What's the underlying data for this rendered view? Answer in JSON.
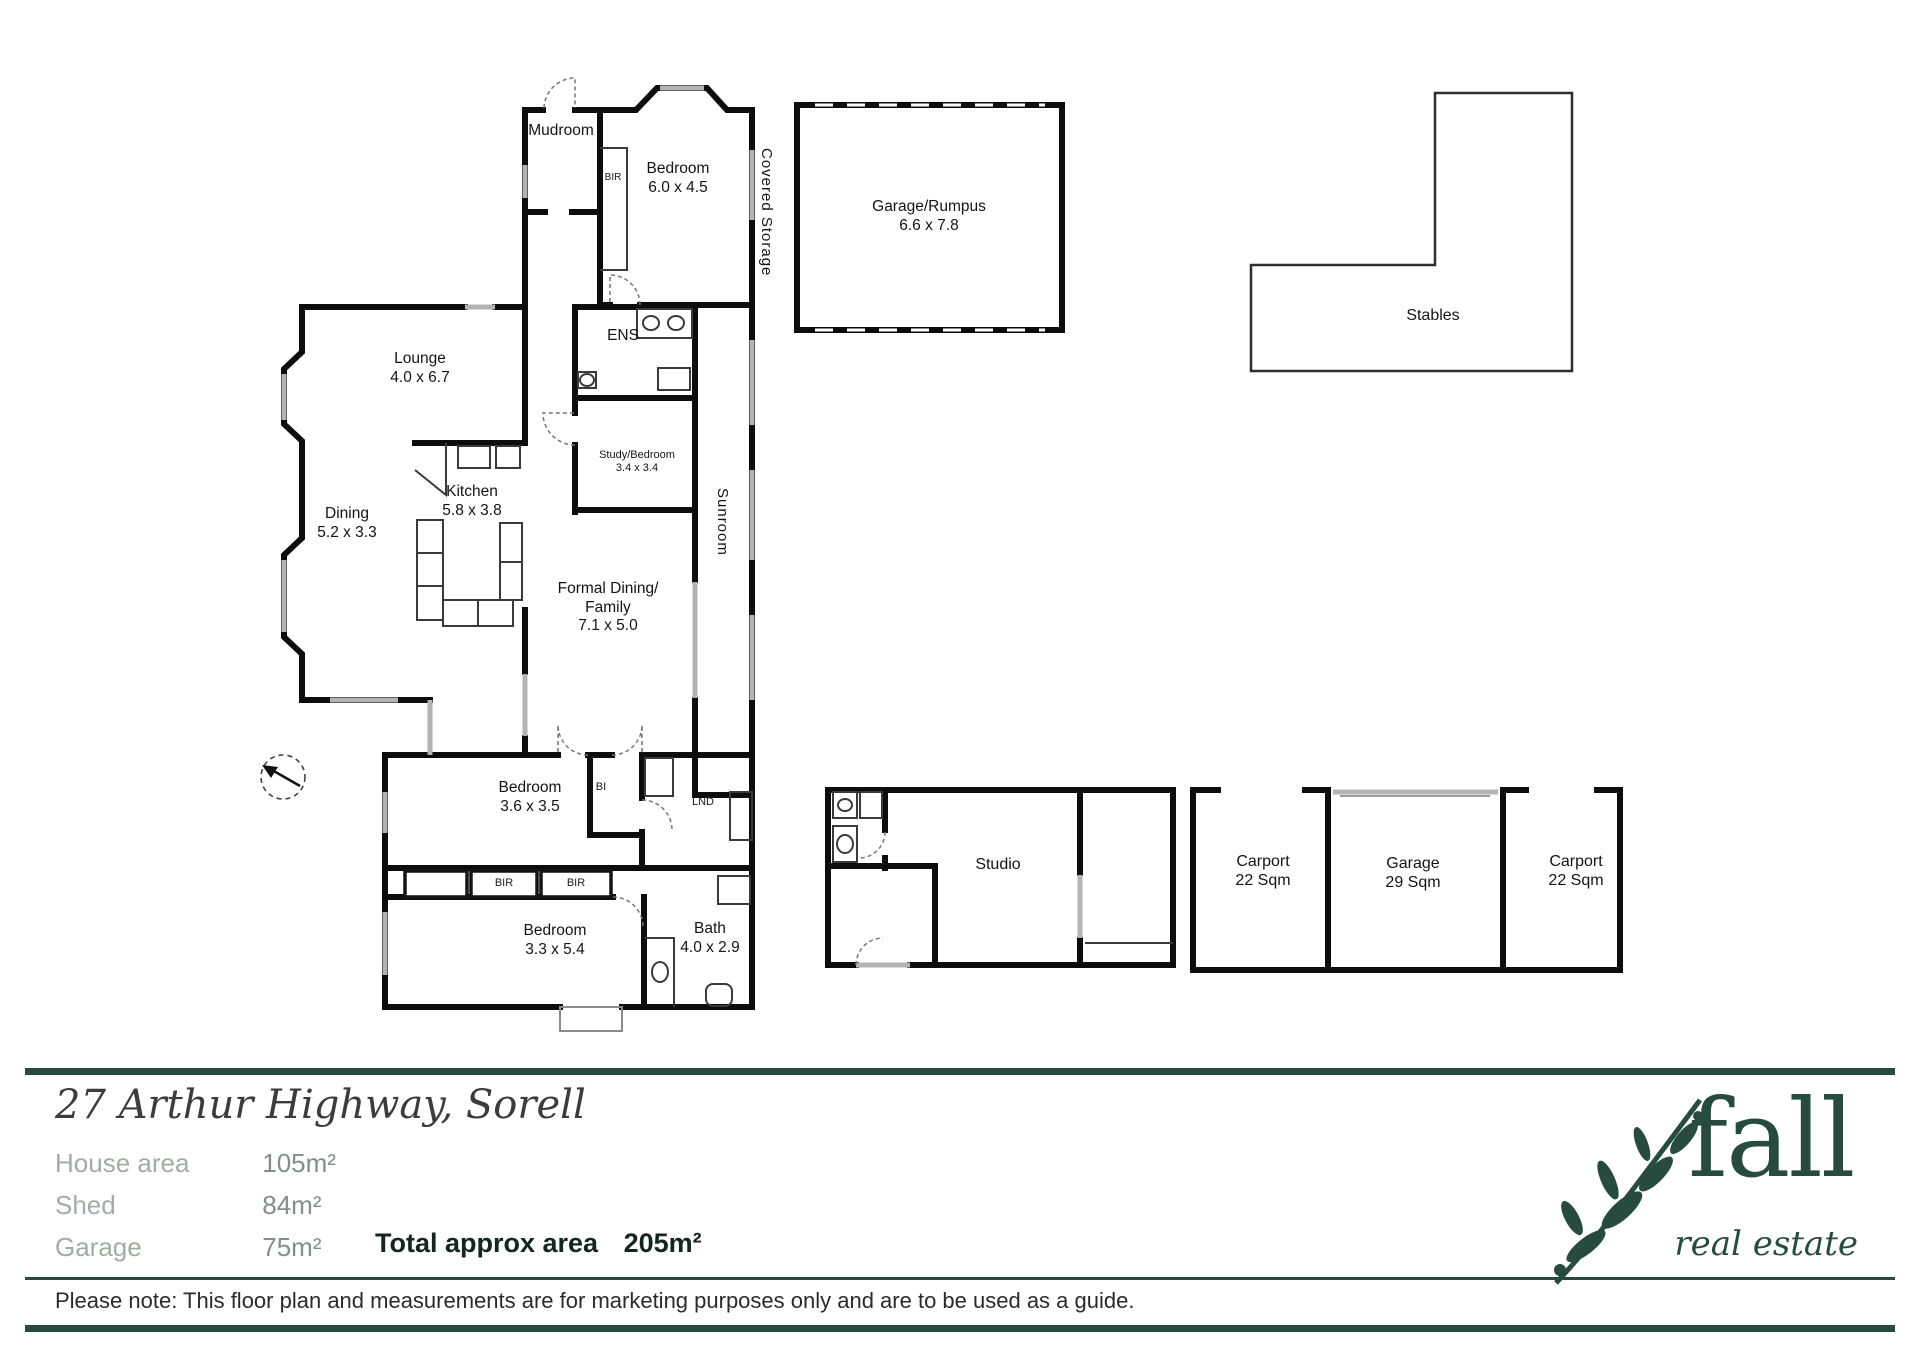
{
  "accent": "#274c3d",
  "rooms": {
    "mudroom": {
      "name": "Mudroom"
    },
    "bedroom_top": {
      "name": "Bedroom",
      "dims": "6.0 x 4.5"
    },
    "bir_top": "BIR",
    "covered_storage": "Covered Storage",
    "garage_rumpus": {
      "name": "Garage/Rumpus",
      "dims": "6.6 x 7.8"
    },
    "stables": "Stables",
    "lounge": {
      "name": "Lounge",
      "dims": "4.0 x 6.7"
    },
    "dining": {
      "name": "Dining",
      "dims": "5.2 x 3.3"
    },
    "kitchen": {
      "name": "Kitchen",
      "dims": "5.8 x 3.8"
    },
    "ens": "ENS",
    "study_bedroom": {
      "name": "Study/Bedroom",
      "dims": "3.4 x 3.4"
    },
    "sunroom": "Sunroom",
    "formal_dining": {
      "line1": "Formal Dining/",
      "line2": "Family",
      "dims": "7.1 x 5.0"
    },
    "bedroom_mid": {
      "name": "Bedroom",
      "dims": "3.6 x 3.5"
    },
    "bi": "BI",
    "lnd": "LND",
    "bir_a": "BIR",
    "bir_b": "BIR",
    "bedroom_bottom": {
      "name": "Bedroom",
      "dims": "3.3 x 5.4"
    },
    "bath": {
      "name": "Bath",
      "dims": "4.0 x 2.9"
    },
    "studio": "Studio",
    "carport_left": {
      "name": "Carport",
      "dims": "22 Sqm"
    },
    "garage_shed": {
      "name": "Garage",
      "dims": "29 Sqm"
    },
    "carport_right": {
      "name": "Carport",
      "dims": "22 Sqm"
    }
  },
  "footer": {
    "address": "27 Arthur Highway, Sorell",
    "area_rows": [
      {
        "label": "House area",
        "value": "105m²"
      },
      {
        "label": "Shed",
        "value": "84m²"
      },
      {
        "label": "Garage",
        "value": "75m²"
      }
    ],
    "total_label": "Total approx area",
    "total_value": "205m²",
    "disclaimer": "Please note: This floor plan and measurements are for marketing purposes only and are to be used as a guide.",
    "logo_brand": "fall",
    "logo_tagline": "real estate"
  }
}
